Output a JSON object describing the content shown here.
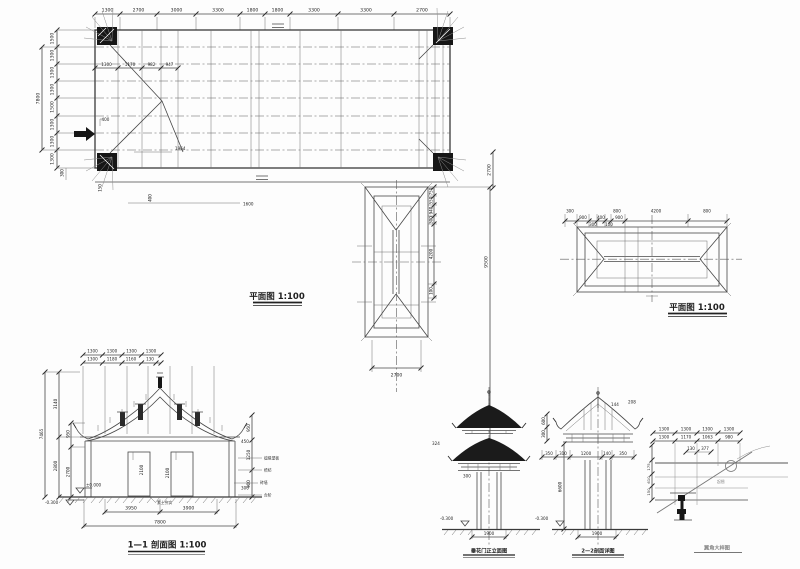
{
  "fp": {
    "title": "平面图  1:100",
    "top": [
      "1300",
      "2700",
      "3000",
      "3300",
      "1800",
      "1800",
      "3300",
      "3300",
      "2700"
    ],
    "left": [
      "1500",
      "1300",
      "1300",
      "1300",
      "1500",
      "1300",
      "1300",
      "1300"
    ],
    "total_left": "7800",
    "inner": [
      "1300",
      "1170",
      "982",
      "947"
    ],
    "a400": "400",
    "a1964": "1964",
    "a300": "300",
    "a150": "150",
    "a400b": "400",
    "a1600": "1600",
    "a2700": "2700"
  },
  "gp": {
    "side": [
      "750",
      "550",
      "940",
      "300",
      "4200",
      "100"
    ],
    "total": "9500",
    "bottom": "2700"
  },
  "rp": {
    "title": "平面图  1:100",
    "row1": [
      "300",
      "800",
      "4200",
      "800"
    ],
    "row2": [
      "900",
      "300",
      "400",
      "100",
      "900"
    ]
  },
  "sec": {
    "title": "1—1 剖面图 1:100",
    "top1": [
      "1300",
      "1300",
      "1300",
      "1300"
    ],
    "top2": [
      "1300",
      "1180",
      "1160",
      "130"
    ],
    "total_left": "7465",
    "l3140": "3140",
    "l2800": "2800",
    "l950": "950",
    "l2700": "2700",
    "r950": "950",
    "r1250": "1250",
    "r900": "900",
    "r450": "450",
    "r300": "300",
    "i2100a": "2100",
    "i2100b": "2100",
    "zero": "±0.000",
    "minus": "-0.300",
    "b3950": "3950",
    "b3900": "3900",
    "b7800": "7800",
    "notes": [
      "檩椽望板",
      "檐枋",
      "砖墙",
      "台阶",
      "素土夯实"
    ]
  },
  "el": {
    "title": "垂花门正立面图",
    "d324": "324",
    "d300": "300",
    "lvl": "-0.300",
    "bot": "1900"
  },
  "er": {
    "title": "2—2剖面详图",
    "d144": "144",
    "d208": "208",
    "s600": "600",
    "s300": "300",
    "row": [
      "350",
      "310",
      "1200",
      "140",
      "350"
    ],
    "total": "6600",
    "lvl": "-0.300",
    "bot": "1900"
  },
  "dt": {
    "title": "翼角大样图",
    "row1": [
      "1300",
      "1300",
      "1300",
      "1300"
    ],
    "row2": [
      "1300",
      "1170",
      "1063",
      "980"
    ],
    "d130": "130",
    "d377": "377",
    "lv": [
      "175",
      "610",
      "150"
    ],
    "note": "起翘"
  }
}
